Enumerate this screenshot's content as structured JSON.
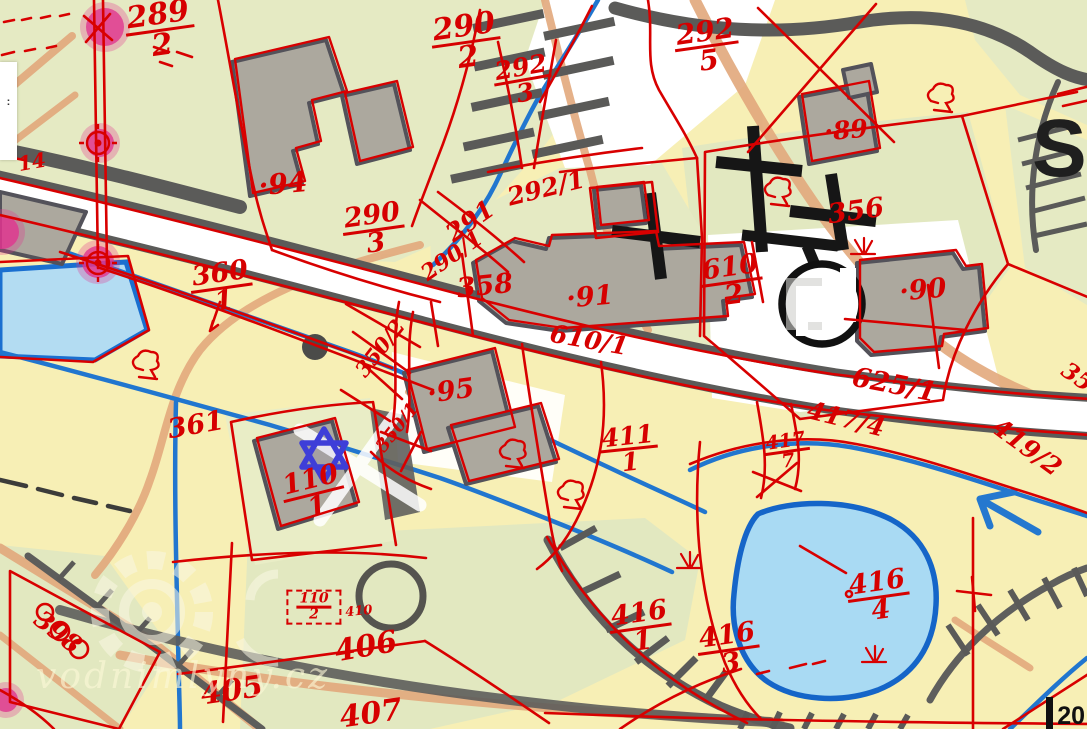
{
  "map": {
    "watermark": {
      "text": "vodnimlyny.cz"
    },
    "big_letter": "S",
    "scale_label": "20",
    "edge_popup_text": ":",
    "colors": {
      "cadastral_red": "#d60000",
      "water_fill": "#a9daf3",
      "water_line": "#2176cf",
      "pond_border": "#1565c8",
      "road_casing": "#5b5b59",
      "building_fill": "#aca89e",
      "terrain_green": "#e5eac3",
      "terrain_yellow": "#f7efb5",
      "path_orange": "#e2a87c",
      "highlight_pink": "#e0358f",
      "marker_blue": "#3e3ed8"
    },
    "marker": {
      "type": "six-pointed-star",
      "x": 324,
      "y": 455
    },
    "highlight_points": [
      {
        "x": 105,
        "y": 27,
        "r": 19
      },
      {
        "x": 100,
        "y": 143,
        "r": 14
      },
      {
        "x": 98,
        "y": 262,
        "r": 16
      },
      {
        "x": 2,
        "y": 232,
        "r": 17
      },
      {
        "x": 6,
        "y": 700,
        "r": 12
      }
    ],
    "symbols": [
      {
        "t": "tree",
        "x": 145,
        "y": 363
      },
      {
        "t": "tree",
        "x": 570,
        "y": 493
      },
      {
        "t": "tree",
        "x": 940,
        "y": 96
      },
      {
        "t": "tree",
        "x": 777,
        "y": 190
      },
      {
        "t": "tree",
        "x": 512,
        "y": 452
      },
      {
        "t": "grass",
        "x": 862,
        "y": 252
      },
      {
        "t": "grass",
        "x": 688,
        "y": 566
      },
      {
        "t": "grass",
        "x": 873,
        "y": 660
      },
      {
        "t": "control",
        "x": 98,
        "y": 143
      },
      {
        "t": "control",
        "x": 98,
        "y": 263
      }
    ],
    "labels": [
      {
        "n": "289",
        "d": "2",
        "x": 160,
        "y": 30,
        "r": -8,
        "s": 30
      },
      {
        "n": "290",
        "d": "2",
        "x": 466,
        "y": 42,
        "r": -8,
        "s": 30
      },
      {
        "n": "292",
        "d": "3",
        "x": 523,
        "y": 80,
        "r": -10,
        "s": 25
      },
      {
        "n": "292",
        "d": "5",
        "x": 707,
        "y": 46,
        "r": -8,
        "s": 28
      },
      {
        "n": "290",
        "d": "3",
        "x": 374,
        "y": 230,
        "r": -8,
        "s": 27
      },
      {
        "n": "360",
        "d": "1",
        "x": 222,
        "y": 288,
        "r": -8,
        "s": 27
      },
      {
        "n": "610",
        "d": "2",
        "x": 732,
        "y": 282,
        "r": -8,
        "s": 27
      },
      {
        "n": "110",
        "d": "1",
        "x": 314,
        "y": 494,
        "r": -14,
        "s": 27
      },
      {
        "n": "411",
        "d": "1",
        "x": 629,
        "y": 449,
        "r": -6,
        "s": 25
      },
      {
        "n": "417",
        "d": "7",
        "x": 787,
        "y": 452,
        "r": -8,
        "s": 19
      },
      {
        "n": "416",
        "d": "4",
        "x": 879,
        "y": 597,
        "r": -8,
        "s": 27
      },
      {
        "n": "416",
        "d": "1",
        "x": 641,
        "y": 628,
        "r": -8,
        "s": 27
      },
      {
        "n": "416",
        "d": "3",
        "x": 729,
        "y": 650,
        "r": -8,
        "s": 27
      },
      {
        "n": "110",
        "d": "2",
        "x": 314,
        "y": 607,
        "r": 0,
        "s": 14,
        "box": 1
      },
      {
        "t": "·94",
        "x": 283,
        "y": 184,
        "r": -5,
        "s": 28
      },
      {
        "t": "·89",
        "x": 846,
        "y": 130,
        "r": -5,
        "s": 25
      },
      {
        "t": "·90",
        "x": 923,
        "y": 291,
        "r": -5,
        "s": 27
      },
      {
        "t": "·91",
        "x": 590,
        "y": 298,
        "r": -5,
        "s": 27
      },
      {
        "t": "·95",
        "x": 451,
        "y": 392,
        "r": -8,
        "s": 27
      },
      {
        "t": "356",
        "x": 856,
        "y": 212,
        "r": -8,
        "s": 27
      },
      {
        "t": "358",
        "x": 485,
        "y": 287,
        "r": -6,
        "s": 27
      },
      {
        "t": "361",
        "x": 196,
        "y": 426,
        "r": -10,
        "s": 27
      },
      {
        "t": "291",
        "x": 470,
        "y": 221,
        "r": -35,
        "s": 25
      },
      {
        "t": "290/1",
        "x": 452,
        "y": 256,
        "r": -35,
        "s": 22
      },
      {
        "t": "292/1",
        "x": 546,
        "y": 188,
        "r": -14,
        "s": 25
      },
      {
        "t": "350/2",
        "x": 380,
        "y": 348,
        "r": -52,
        "s": 21
      },
      {
        "t": "350/1",
        "x": 398,
        "y": 428,
        "r": -52,
        "s": 18
      },
      {
        "t": "610/1",
        "x": 589,
        "y": 340,
        "r": 10,
        "s": 25
      },
      {
        "t": "625/1",
        "x": 894,
        "y": 386,
        "r": 11,
        "s": 27
      },
      {
        "t": "417/4",
        "x": 846,
        "y": 419,
        "r": 14,
        "s": 25
      },
      {
        "t": "419/2",
        "x": 1027,
        "y": 447,
        "r": 36,
        "s": 25
      },
      {
        "t": "406",
        "x": 366,
        "y": 647,
        "r": -10,
        "s": 30
      },
      {
        "t": "405",
        "x": 232,
        "y": 691,
        "r": -8,
        "s": 30
      },
      {
        "t": "407",
        "x": 371,
        "y": 714,
        "r": -8,
        "s": 30
      },
      {
        "t": "398",
        "x": 58,
        "y": 632,
        "r": 38,
        "s": 25
      },
      {
        "t": "410",
        "x": 359,
        "y": 612,
        "r": -5,
        "s": 13
      },
      {
        "t": "14",
        "x": 32,
        "y": 162,
        "r": -10,
        "s": 20
      },
      {
        "t": "35",
        "x": 1077,
        "y": 377,
        "r": 35,
        "s": 23
      }
    ]
  }
}
